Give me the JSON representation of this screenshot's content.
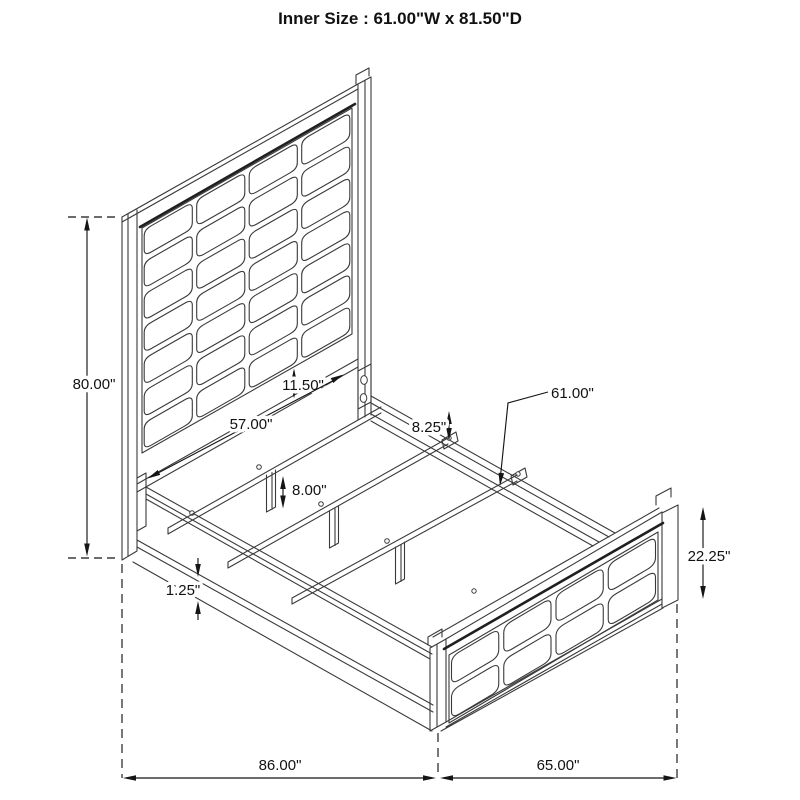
{
  "title": "Inner Size : 61.00\"W x 81.50\"D",
  "dimensions": {
    "headboard_height": "80.00\"",
    "headboard_clearance": "11.50\"",
    "slat_span": "57.00\"",
    "rail_to_slat_height": "8.25\"",
    "slat_length": "61.00\"",
    "leg_height": "8.00\"",
    "rail_lip": "1.25\"",
    "footboard_height": "22.25\"",
    "overall_length": "86.00\"",
    "overall_width": "65.00\""
  },
  "colors": {
    "background": "#ffffff",
    "drawing_line": "#3a3a3a",
    "piping_line": "#1f1f1f",
    "dimension_line": "#151515",
    "text": "#111111"
  }
}
